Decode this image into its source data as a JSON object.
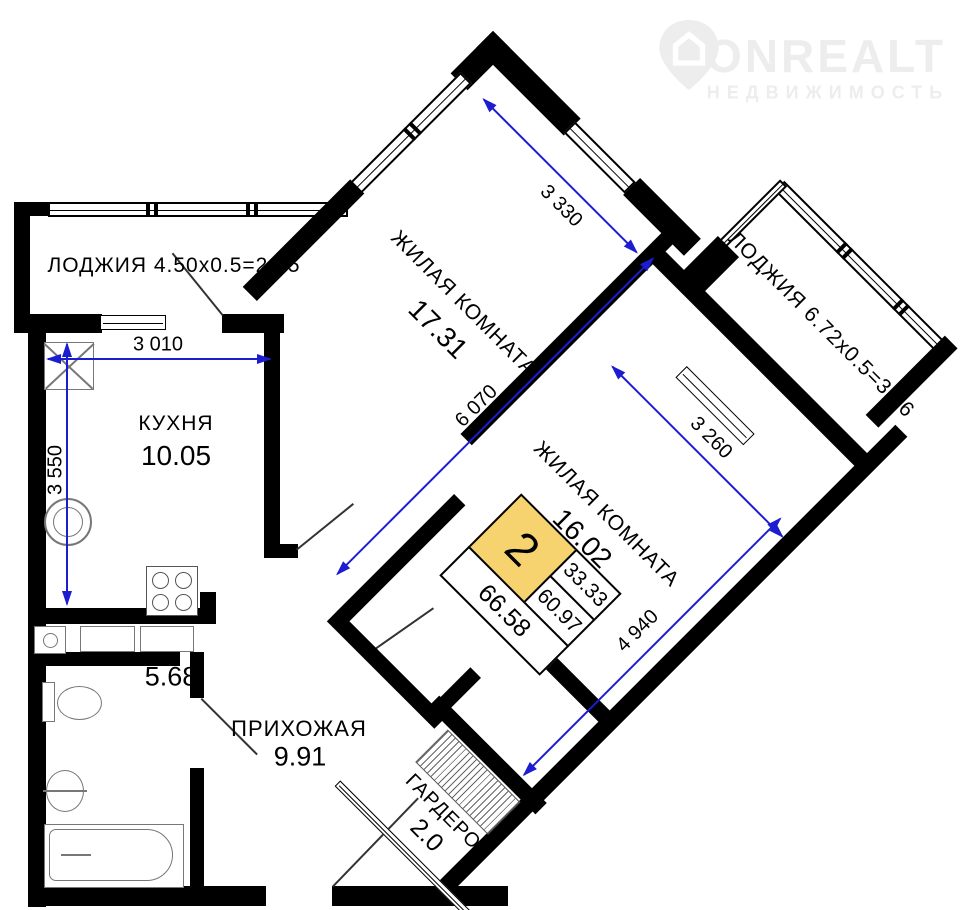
{
  "watermark": {
    "brand": "ONREALT",
    "subtitle": "НЕДВИЖИМОСТЬ"
  },
  "rooms": {
    "loggia_left": {
      "label": "ЛОДЖИЯ 4.50х0.5=2.25"
    },
    "kitchen": {
      "name": "КУХНЯ",
      "area": "10.05"
    },
    "living1": {
      "name": "ЖИЛАЯ КОМНАТА",
      "area": "17.31"
    },
    "living2": {
      "name": "ЖИЛАЯ КОМНАТА",
      "area": "16.02"
    },
    "loggia_right": {
      "label": "ЛОДЖИЯ 6.72х0.5=3.36"
    },
    "bathroom": {
      "area": "5.68"
    },
    "hallway": {
      "name": "ПРИХОЖАЯ",
      "area": "9.91"
    },
    "wardrobe": {
      "name": "ГАРДЕРОБ",
      "area": "2.0"
    }
  },
  "dimensions": {
    "kitchen_width": "3 010",
    "kitchen_height": "3 550",
    "living1_width": "3 330",
    "living1_length": "6 070",
    "living2_width": "3 260",
    "living2_length": "4 940"
  },
  "stamp": {
    "rooms_count": "2",
    "living_area": "33.33",
    "area": "60.97",
    "total_area": "66.58"
  },
  "colors": {
    "wall": "#000000",
    "dim_blue": "#1c1cd0",
    "stamp_yellow": "#f6d36f",
    "watermark_gray": "#ededed"
  }
}
